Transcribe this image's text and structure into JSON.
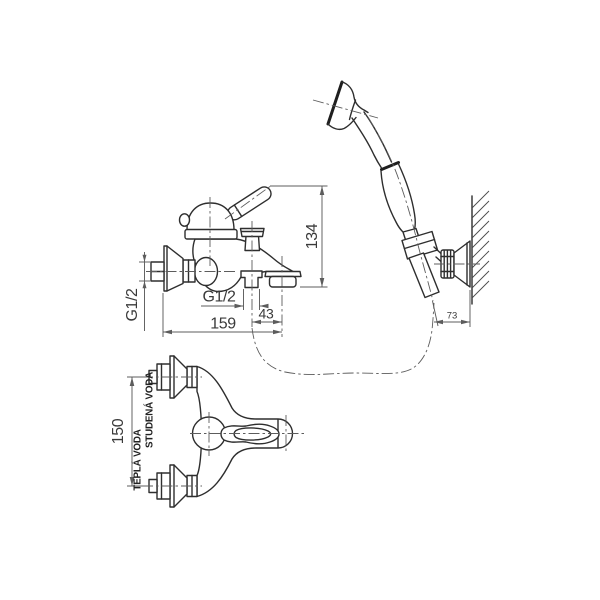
{
  "drawing": {
    "title": "bath-mixer-with-hand-shower-dimension-drawing",
    "colors": {
      "background": "#ffffff",
      "main_line": "#2e2e2e",
      "thin_line": "#5c5c5c",
      "text": "#3a3a3a"
    },
    "side_view": {
      "dim_height": "134",
      "dim_reach": "159",
      "dim_outlet_offset": "43",
      "thread_shower_outlet": "G1/2",
      "thread_wall_inlet": "G1/2"
    },
    "plan_view": {
      "dim_inlet_spacing": "150",
      "label_cold_water": "STUDENÁ VODA",
      "label_hot_water": "TEPLÁ VODA"
    },
    "shower_view": {
      "dim_bracket_offset": "73"
    }
  }
}
